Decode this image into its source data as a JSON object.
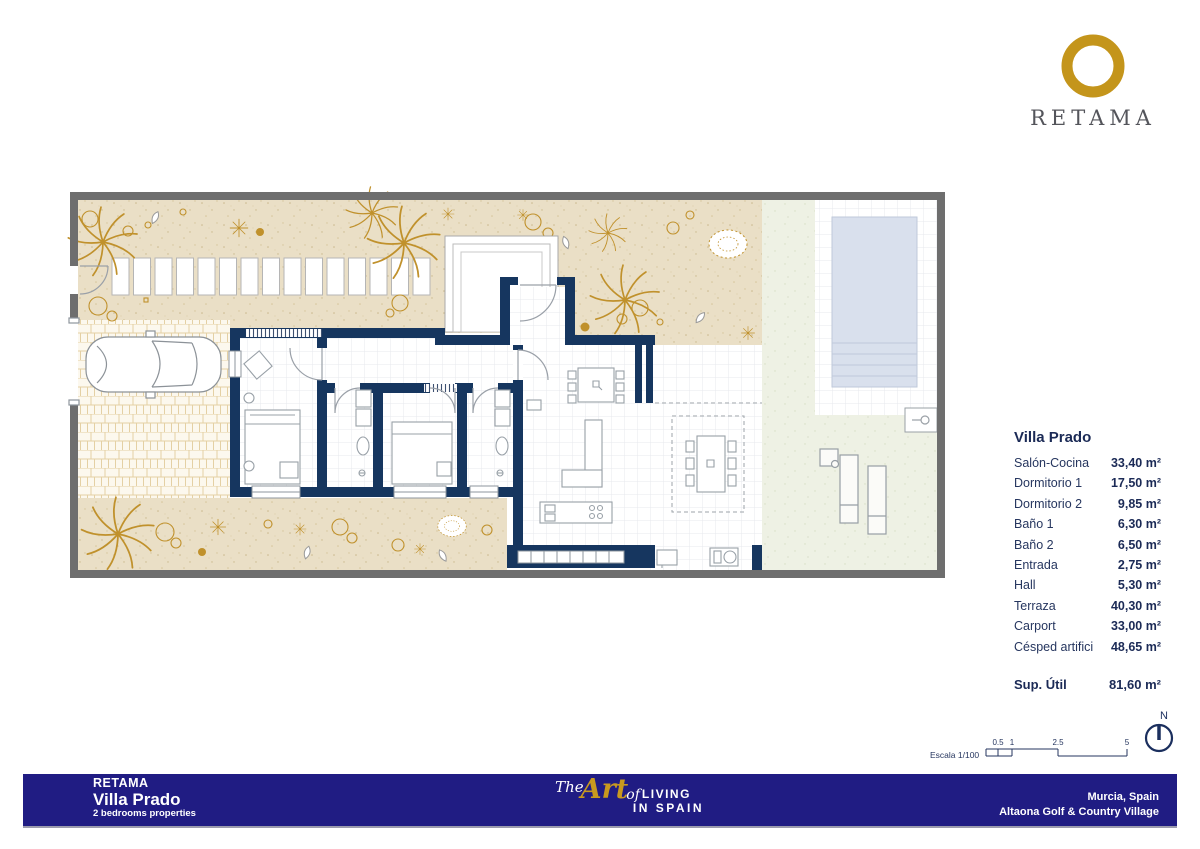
{
  "brand": {
    "name": "RETAMA"
  },
  "colors": {
    "navy_wall": "#16365F",
    "footer_blue": "#201C83",
    "gold": "#C0912C",
    "logo_gold": "#C4951B",
    "sand": "#EADFC6",
    "grass": "#EEF1E4",
    "pool_blue": "#D9E0ED",
    "boundary_gray": "#6E6E6E",
    "text_navy": "#1B2A56"
  },
  "rooms": {
    "title": "Villa Prado",
    "items": [
      {
        "label": "Salón-Cocina",
        "value": "33,40 m²"
      },
      {
        "label": "Dormitorio 1",
        "value": "17,50 m²"
      },
      {
        "label": "Dormitorio 2",
        "value": "9,85 m²"
      },
      {
        "label": "Baño 1",
        "value": "6,30 m²"
      },
      {
        "label": "Baño 2",
        "value": "6,50 m²"
      },
      {
        "label": "Entrada",
        "value": "2,75 m²"
      },
      {
        "label": "Hall",
        "value": "5,30 m²"
      },
      {
        "label": "Terraza",
        "value": "40,30 m²"
      },
      {
        "label": "Carport",
        "value": "33,00 m²"
      },
      {
        "label": "Césped artifici",
        "value": "48,65 m²"
      }
    ],
    "total_label": "Sup. Útil",
    "total_value": "81,60 m²"
  },
  "scale_bar": {
    "label": "Escala 1/100",
    "ticks": [
      "0.5",
      "1",
      "2.5",
      "5"
    ],
    "north_label": "N"
  },
  "footer": {
    "company": "RETAMA",
    "project": "Villa Prado",
    "subtitle": "2 bedrooms properties",
    "tagline_the": "The",
    "tagline_art": "Art",
    "tagline_of": "of",
    "tagline_living": "LIVING",
    "tagline_in_spain": "IN SPAIN",
    "location_city": "Murcia, Spain",
    "location_resort": "Altaona Golf & Country Village"
  }
}
